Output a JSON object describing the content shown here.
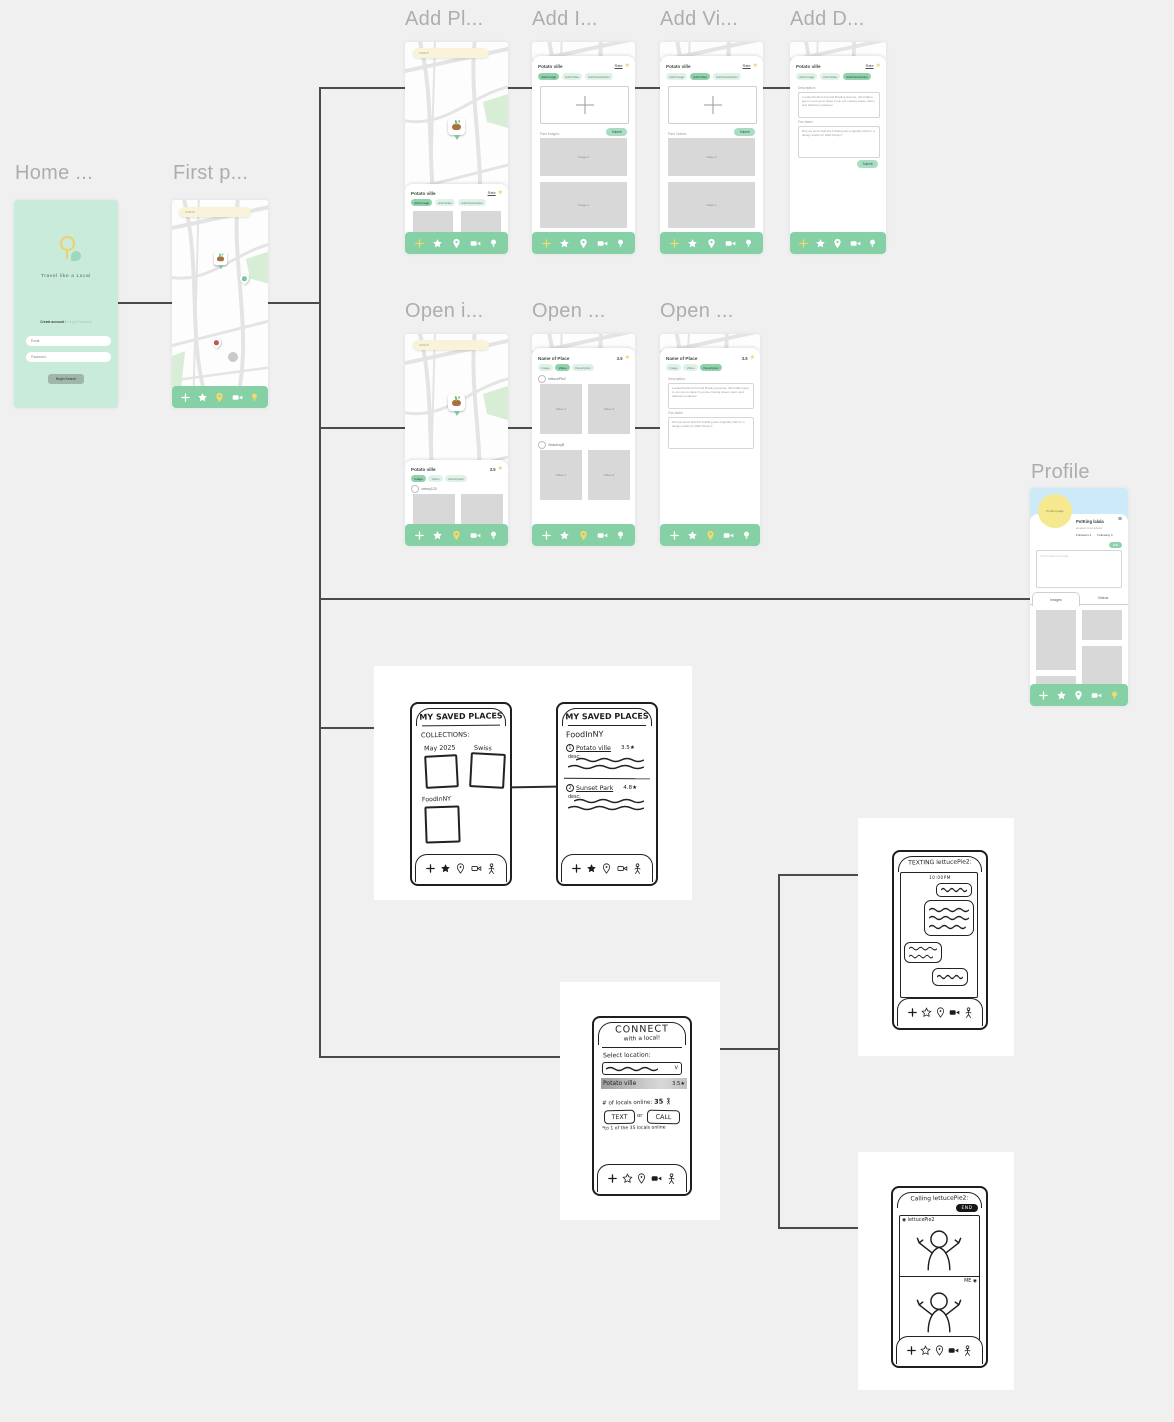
{
  "nav": {
    "icon_names": [
      "add",
      "star",
      "pin",
      "video",
      "bulb"
    ]
  },
  "colors": {
    "mint": "#c9ebda",
    "nav_green": "#85d1a5",
    "accent_yellow": "#f4da66",
    "pill_active": "#8fd2ac",
    "search_cream": "#f9f4d9",
    "profile_blue": "#cdeaf9",
    "profile_yellow": "#f6e88e",
    "sketch_ink": "#1f1f1f"
  },
  "frames": {
    "home": {
      "title": "Home ...",
      "tagline": "Travel like a Local",
      "create_account": "Create account",
      "divider": "/",
      "forgot_password": "Forgot Password",
      "email_label": "Email:",
      "password_label": "Password:",
      "begin_button": "Begin Search"
    },
    "first_page": {
      "title": "First p...",
      "search_placeholder": "search"
    },
    "add_place": {
      "title": "Add Pl...",
      "place_name": "Potato ville",
      "rate_link": "Rate",
      "pills": [
        "Add Image",
        "Add Video",
        "Add Description"
      ]
    },
    "add_image": {
      "title": "Add I...",
      "place_name": "Potato ville",
      "rate_link": "Rate",
      "pills": [
        "Add Image",
        "Add Video",
        "Add Description"
      ],
      "submit": "Submit",
      "past_label": "Past Images:",
      "item1": "Image 2",
      "item2": "Image 1"
    },
    "add_video": {
      "title": "Add Vi...",
      "place_name": "Potato ville",
      "rate_link": "Rate",
      "pills": [
        "Add Image",
        "Add Video",
        "Add Description"
      ],
      "submit": "Submit",
      "past_label": "Past Videos:",
      "item1": "Video 2",
      "item2": "Video 1"
    },
    "add_description": {
      "title": "Add D...",
      "place_name": "Potato ville",
      "rate_link": "Rate",
      "pills": [
        "Add Image",
        "Add Video",
        "Add Description"
      ],
      "description_label": "Description:",
      "description_text": "Located behind 2nd and Bowling Avenue, this hidden gem is your go-to place if you are craving sweet, warm and delicious potatoes!",
      "fun_label": "Fun facts!",
      "fun_text": "Did you know that this building was originally built for a design studio for Walt Disney?",
      "submit": "Submit"
    },
    "open_image": {
      "title": "Open i...",
      "place_name": "Potato ville",
      "rating": "3.5",
      "pills": [
        "Image",
        "Video",
        "Description"
      ],
      "user": "celery123",
      "item1": "image here",
      "item2": "image here"
    },
    "open_video": {
      "title": "Open ...",
      "place_name": "Name of Place",
      "rating": "3.5",
      "pills": [
        "Image",
        "Video",
        "Description"
      ],
      "user1": "lettucePie2",
      "user2": "BokchoyB",
      "v1": "Video 1",
      "v2": "Video 2"
    },
    "open_description": {
      "title": "Open ...",
      "place_name": "Name of Place",
      "rating": "3.5",
      "pills": [
        "Image",
        "Video",
        "Description"
      ],
      "description_label": "Description:",
      "description_text": "Located behind 2nd and Bowling Avenue, this hidden gem is your go-to place if you are craving sweet, warm and delicious potatoes!",
      "fun_label": "Fun facts!",
      "fun_text": "Did you know that this building was originally built for a design studio for Walt Disney?"
    },
    "profile": {
      "title": "Profile",
      "avatar_label": "Profile Image",
      "menu_icon": "≡",
      "name": "PotKing lalala",
      "subtitle": "amateur local advisor",
      "followers": "Followers 4",
      "following": "Following 4",
      "edit_button": "Edit",
      "about_placeholder": "Tell us about yourself...",
      "tab_images": "Images",
      "tab_videos": "Videos"
    }
  },
  "sketches": {
    "saved_collections": {
      "header": "MY SAVED PLACES",
      "subheader": "COLLECTIONS:",
      "collection1": "May 2025",
      "collection2": "Swiss",
      "collection3": "FoodInNY"
    },
    "saved_list": {
      "header": "MY SAVED PLACES",
      "list_title": "FoodInNY",
      "item1_num": "1",
      "item1_name": "Potato ville",
      "item1_rating": "3.5★",
      "item1_desc": "desc:",
      "item2_num": "2",
      "item2_name": "Sunset Park",
      "item2_rating": "4.8★",
      "item2_desc": "desc:"
    },
    "connect": {
      "header_line1": "CONNECT",
      "header_line2": "with  a  local!",
      "select_label": "Select location:",
      "selected_place": "Potato ville",
      "selected_rating": "3.5★",
      "locals_label": "# of locals online:",
      "locals_count": "35",
      "text_button": "TEXT",
      "or_label": "or",
      "call_button": "CALL",
      "note": "*to 1 of the 35 locals online"
    },
    "texting": {
      "header": "TEXTING lettucePie2:",
      "timestamp": "10:00PM"
    },
    "calling": {
      "header": "Calling lettucePie2:",
      "end_button": "END",
      "remote_label": "lettucePie2",
      "me_label": "ME"
    }
  }
}
